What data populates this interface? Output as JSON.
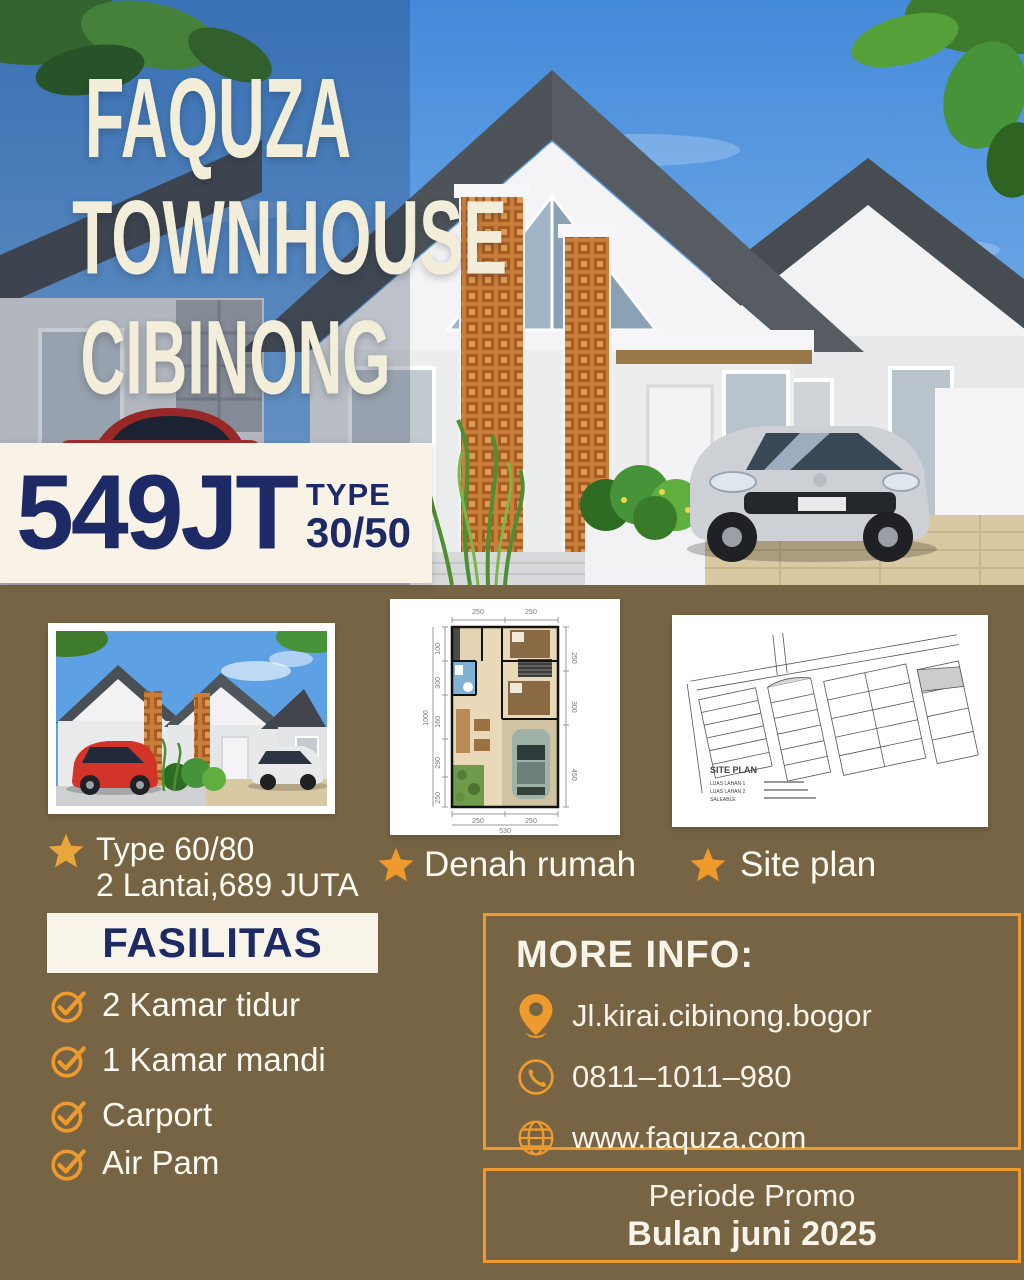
{
  "colors": {
    "background_brown": "#776444",
    "brand_navy": "#1d2a66",
    "accent_orange": "#ee9a2c",
    "cream": "#f8f3e6",
    "sky_blue": "#4a90dd",
    "title_cream": "#f3eeda"
  },
  "hero": {
    "title_line1": "FAQUZA",
    "title_line2": "TOWNHOUSE",
    "title_line3": "CIBINONG"
  },
  "price_badge": {
    "price": "549JT",
    "type_label": "TYPE",
    "type_value": "30/50"
  },
  "gallery": {
    "photo_caption_line1": "Type 60/80",
    "photo_caption_line2": "2 Lantai,689 JUTA",
    "floorplan_caption": "Denah rumah",
    "siteplan_caption": "Site plan"
  },
  "floorplan": {
    "dims_top": [
      "250",
      "250"
    ],
    "dims_left": [
      "100",
      "300",
      "160",
      "290",
      "250"
    ],
    "dim_left_total": "1000",
    "dims_right": [
      "250",
      "300",
      "450"
    ],
    "dims_bottom": [
      "250",
      "250"
    ],
    "dim_bottom_total": "530"
  },
  "siteplan": {
    "label": "SITE PLAN",
    "legend": [
      "LUAS LAHAN 1",
      "LUAS LAHAN 2",
      "SALEABLE"
    ]
  },
  "fasilitas": {
    "heading": "FASILITAS",
    "items": [
      "2 Kamar tidur",
      "1 Kamar mandi",
      "Carport",
      "Air Pam"
    ]
  },
  "more_info": {
    "heading": "MORE INFO:",
    "address": "Jl.kirai.cibinong.bogor",
    "phone": "0811–1011–980",
    "website": "www.faquza.com"
  },
  "promo": {
    "line1": "Periode Promo",
    "line2": "Bulan juni 2025"
  },
  "icons": {
    "star": "star-icon",
    "check": "check-circle-icon",
    "pin": "location-pin-icon",
    "phone": "phone-icon",
    "globe": "globe-icon"
  }
}
